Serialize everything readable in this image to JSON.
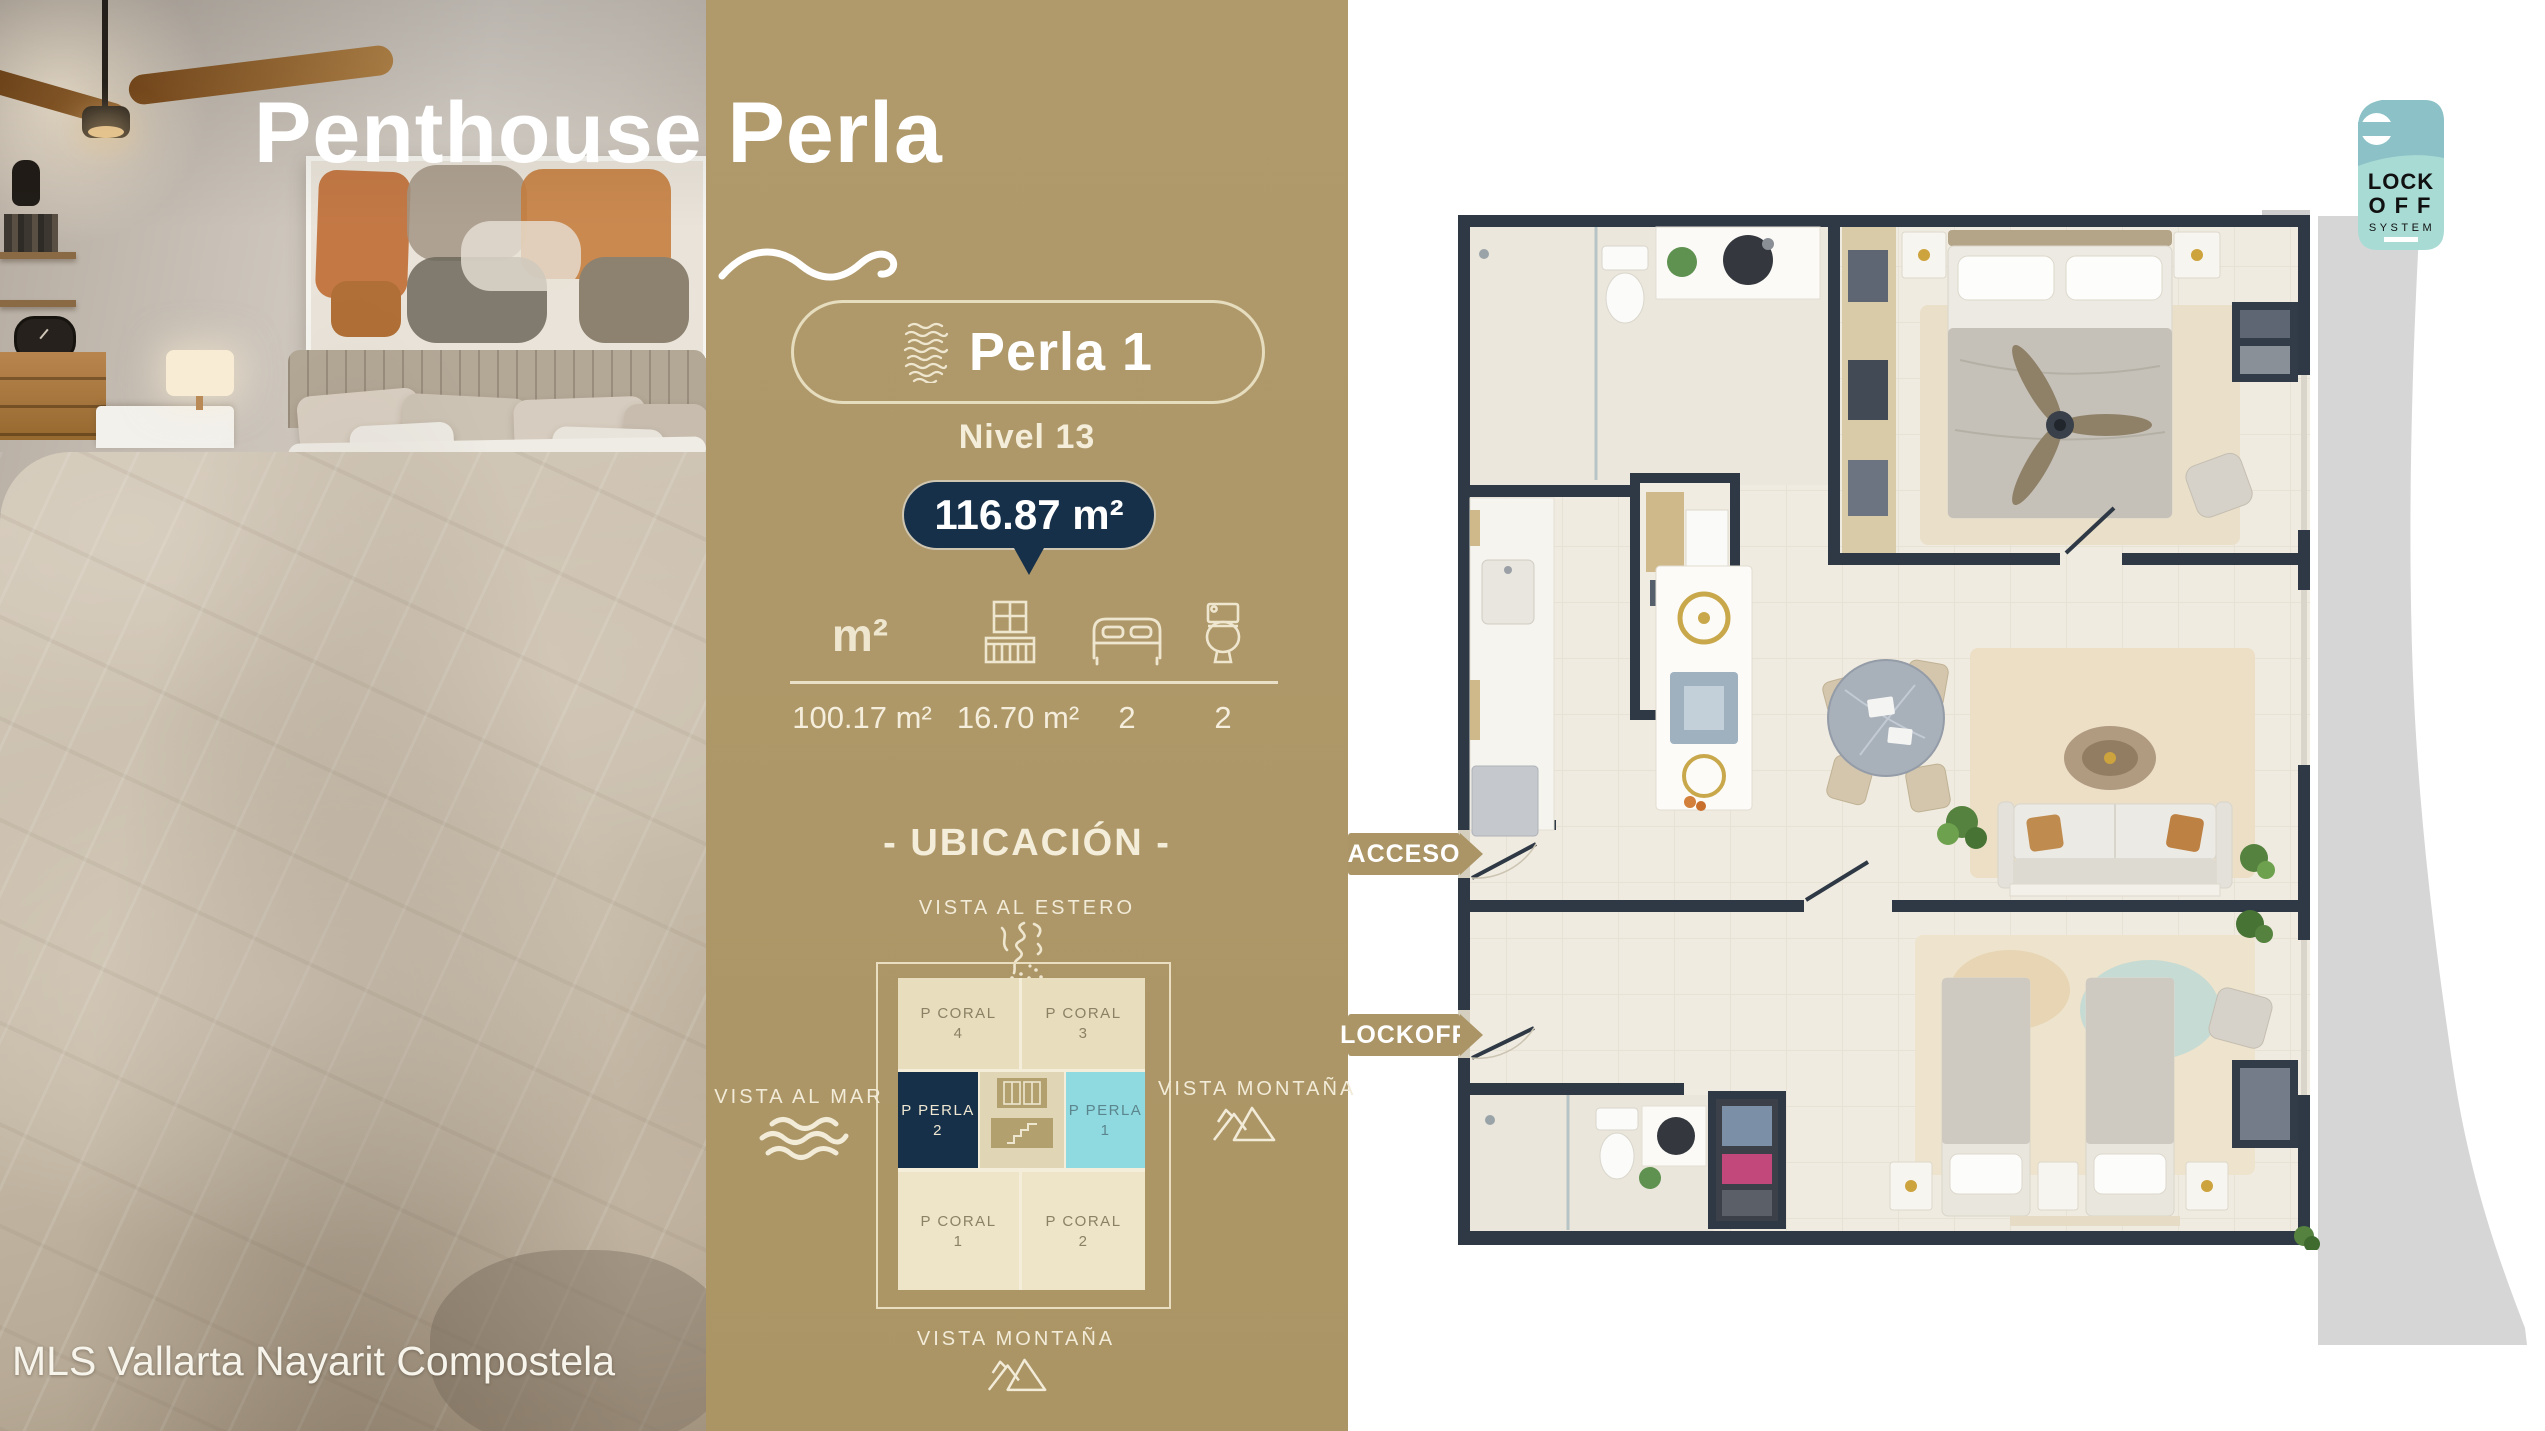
{
  "header": {
    "title": "Penthouse Perla",
    "watermark": "MLS Vallarta Nayarit Compostela"
  },
  "unit_card": {
    "name": "Perla 1",
    "level": "Nivel 13",
    "total_area": "116.87 m²",
    "stats": [
      {
        "id": "interior-area",
        "icon": "m2-text",
        "icon_label": "m²",
        "value": "100.17 m²"
      },
      {
        "id": "terrace-area",
        "icon": "balcony-icon",
        "value": "16.70 m²"
      },
      {
        "id": "bedrooms",
        "icon": "bed-icon",
        "value": "2"
      },
      {
        "id": "bathrooms",
        "icon": "toilet-icon",
        "value": "2"
      }
    ]
  },
  "location": {
    "heading": "- UBICACIÓN -",
    "views": {
      "top": "VISTA AL ESTERO",
      "left": "VISTA AL MAR",
      "right": "VISTA MONTAÑA",
      "bottom": "VISTA MONTAÑA"
    },
    "grid": {
      "cells": [
        {
          "name": "P CORAL",
          "number": "4",
          "position": "top-left"
        },
        {
          "name": "P CORAL",
          "number": "3",
          "position": "top-right"
        },
        {
          "name": "P PERLA",
          "number": "2",
          "position": "mid-left",
          "highlight": "navy"
        },
        {
          "name": "P PERLA",
          "number": "1",
          "position": "mid-right",
          "highlight": "cyan"
        },
        {
          "name": "P CORAL",
          "number": "1",
          "position": "bottom-left"
        },
        {
          "name": "P CORAL",
          "number": "2",
          "position": "bottom-right"
        }
      ]
    }
  },
  "floor_plan": {
    "access_label": "ACCESO",
    "lockoff_label": "LOCKOFF"
  },
  "lockoff_badge": {
    "line1": "LOCK",
    "line2": "OFF",
    "line3": "SYSTEM"
  },
  "colors": {
    "gold": "#ab9566",
    "navy": "#16304a",
    "cream": "#efe6cf",
    "cyan": "#8fd9e0",
    "badge_teal_dark": "#8bc1c7",
    "badge_teal_light": "#a9dbd5",
    "wall_navy": "#2e3945",
    "gray_shape": "#d6d6d6"
  }
}
